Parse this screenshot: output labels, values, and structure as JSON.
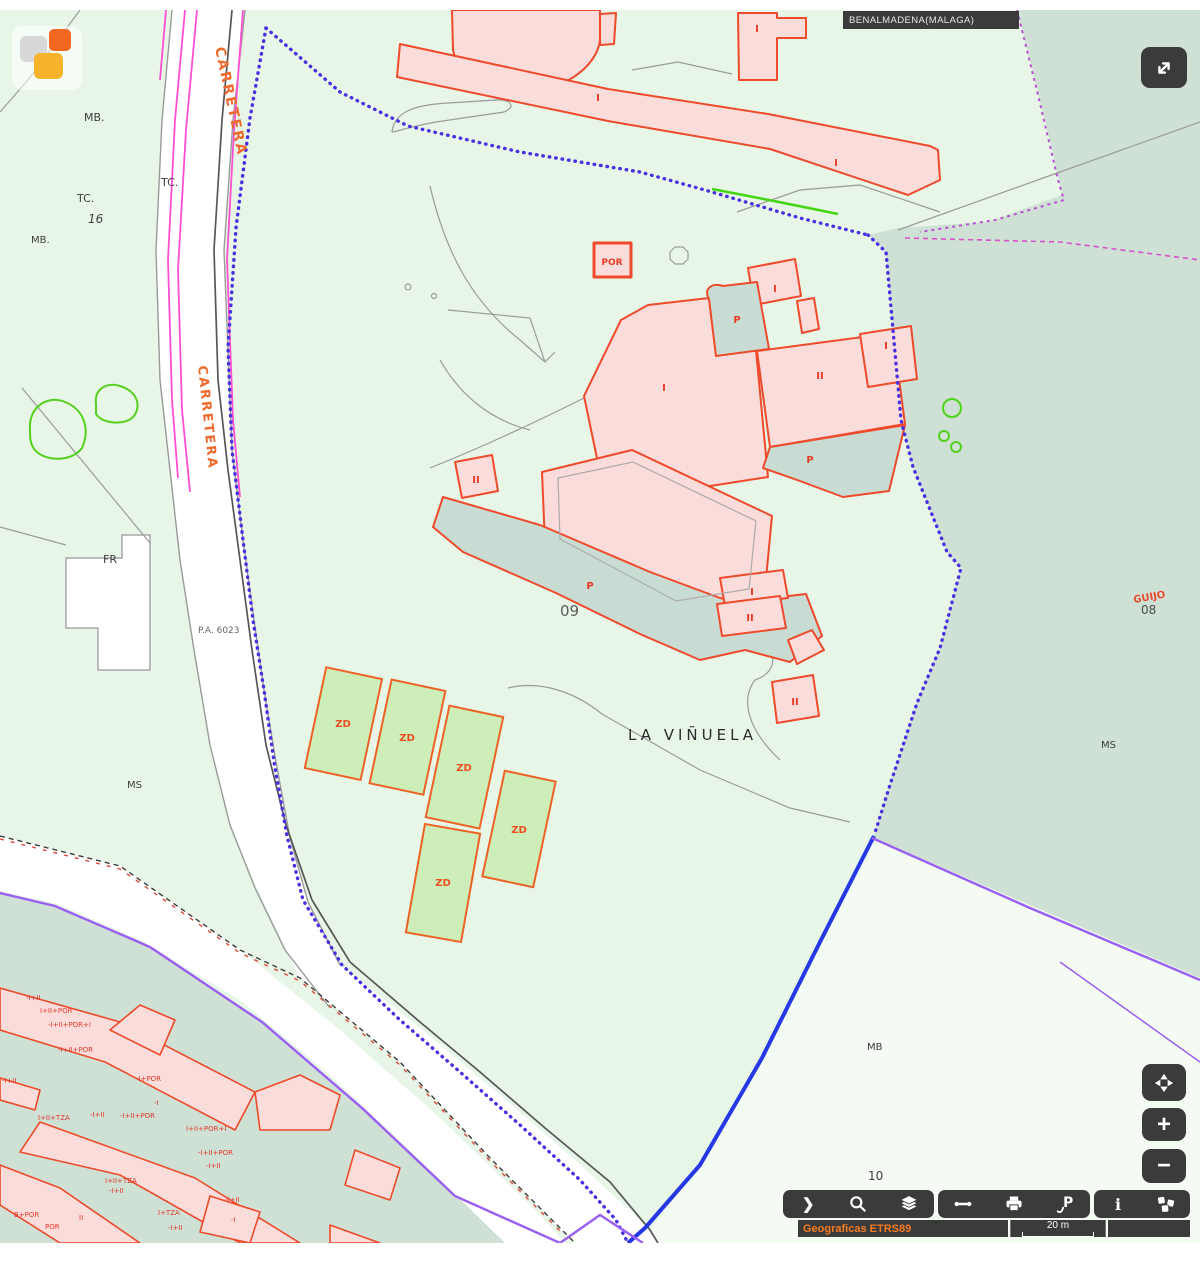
{
  "header": {
    "municipality": "BENALMADENA(MALAGA)"
  },
  "logo": {
    "name": "catastro-logo",
    "colors": {
      "gray": "#d8d8d8",
      "orange": "#f26722",
      "amber": "#f7b32b"
    }
  },
  "controls": {
    "fullscreen_icon": "expand-diagonal",
    "pan_icon": "pan-arrows",
    "zoom_in_label": "+",
    "zoom_out_label": "−"
  },
  "toolbar": {
    "group1_icons": [
      "chevron-right",
      "search",
      "layers"
    ],
    "group2_icons": [
      "measure",
      "print",
      "set-pin"
    ],
    "group3_icons": [
      "info",
      "related-services"
    ],
    "chevron_glyph": "❯",
    "info_glyph": "i",
    "pin_glyph": "P"
  },
  "statusbar": {
    "projection": "Geograficas ETRS89",
    "scale": "20 m"
  },
  "colors": {
    "map_bg": "#e8f6e8",
    "sage_area": "#cfe1d4",
    "light_wedge": "#f3fbf2",
    "road": "#ffffff",
    "building_fill": "#fadcda",
    "building_stroke": "#ee4a2b",
    "patio_fill": "#c9dcd4",
    "zd_fill": "#cdeeb8",
    "zd_stroke": "#ee6325",
    "boundary_dotted": "#4a30e0",
    "boundary_solid": "#2438e6",
    "purple_line": "#9a5ff2",
    "magenta_line": "#ff4fd4",
    "green_line": "#56d01e",
    "ui_dark": "#3b3b3b",
    "projection_text": "#f57b20",
    "building_label": "#e83a26",
    "road_label": "#ef6a2d",
    "place_label": "#3d3d3d"
  },
  "map": {
    "labels": {
      "place": [
        {
          "text": "MB."
        },
        {
          "text": "TC."
        },
        {
          "text": "TC."
        },
        {
          "text": "16"
        },
        {
          "text": "MB."
        },
        {
          "text": "FR"
        },
        {
          "text": "MS"
        },
        {
          "text": "P.A. 6023"
        },
        {
          "text": "09"
        },
        {
          "text": "LA VIÑUELA"
        },
        {
          "text": "MS"
        },
        {
          "text": "MB"
        },
        {
          "text": "10"
        },
        {
          "text": "08"
        }
      ],
      "roads": [
        "CARRETERA",
        "CARRETERA"
      ],
      "guijo": "GUIJO",
      "buildings": [
        "I",
        "I",
        "I",
        "POR",
        "I",
        "P",
        "I",
        "II",
        "I",
        "P",
        "P",
        "I",
        "II",
        "II",
        "II"
      ],
      "zones": [
        "ZD",
        "ZD",
        "ZD",
        "ZD",
        "ZD"
      ],
      "details": [
        "-I+II",
        "I+II+POR",
        "-I+II+POR+I",
        "-I+II+POR",
        "-I+II",
        "I+II+TZA",
        "-I+II",
        "-I+II+POR",
        "-I+POR",
        "-I",
        "I+II+POR+I",
        "-I+II+POR",
        "-I+II",
        "I+II+TZA",
        "-I+II",
        "B+POR",
        "POR",
        "II",
        "I+TZA",
        "-I+II",
        "-I+II",
        "-I"
      ]
    }
  }
}
